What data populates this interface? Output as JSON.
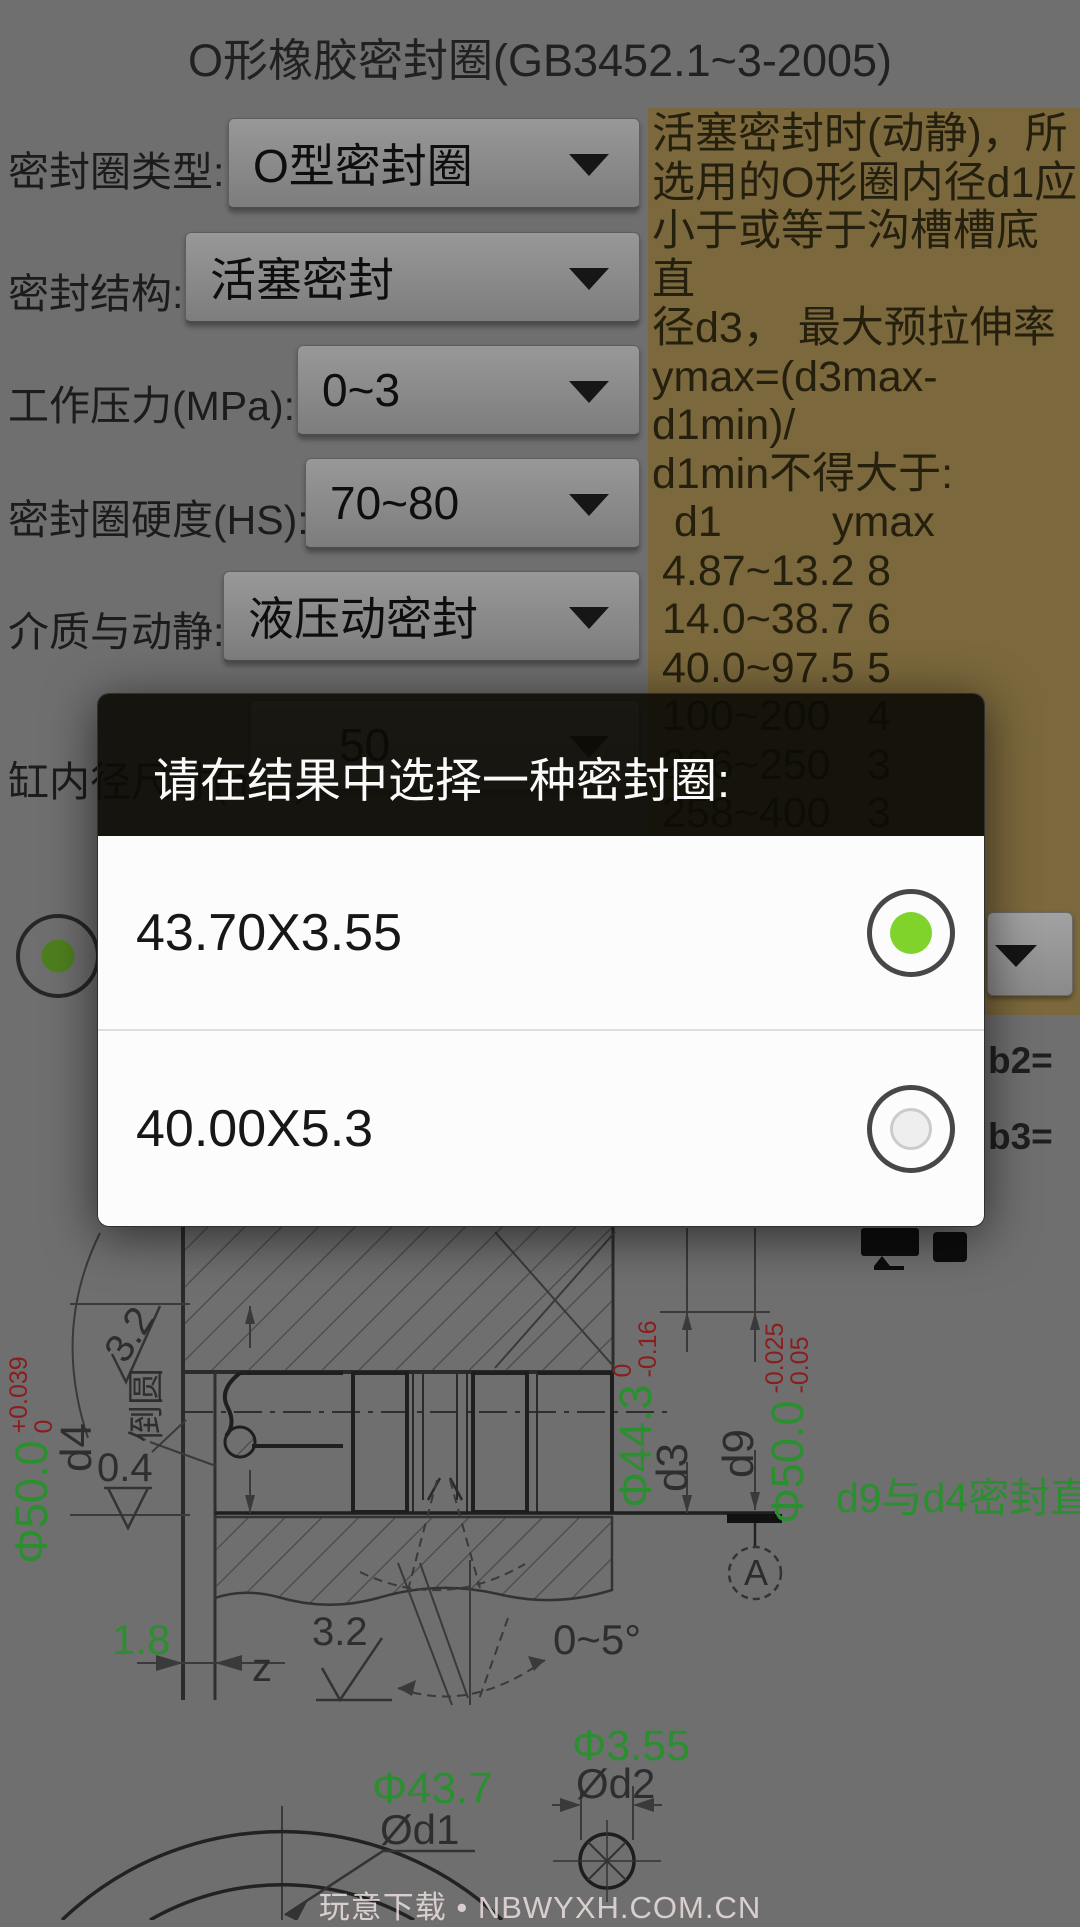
{
  "title": "O形橡胶密封圈(GB3452.1~3-2005)",
  "form": {
    "fields": [
      {
        "label": "密封圈类型:",
        "value": "O型密封圈"
      },
      {
        "label": "密封结构:",
        "value": "活塞密封"
      },
      {
        "label": "工作压力(MPa):",
        "value": "0~3"
      },
      {
        "label": "密封圈硬度(HS):",
        "value": "70~80"
      },
      {
        "label": "介质与动静:",
        "value": "液压动密封"
      },
      {
        "label": "缸内径尺寸(mm):",
        "value": "50"
      }
    ]
  },
  "info_panel": {
    "lines": [
      "活塞密封时(动静)，所",
      "选用的O形圈内径d1应",
      "小于或等于沟槽槽底直",
      "径d3， 最大预拉伸率",
      "ymax=(d3max-d1min)/",
      "d1min不得大于:"
    ],
    "table": {
      "col1": "d1",
      "col2": "ymax",
      "rows": [
        {
          "range": "4.87~13.2",
          "value": "8"
        },
        {
          "range": "14.0~38.7",
          "value": "6"
        },
        {
          "range": "40.0~97.5",
          "value": "5"
        },
        {
          "range": "100~200",
          "value": "4"
        },
        {
          "range": "206~250",
          "value": "3"
        },
        {
          "range": "258~400",
          "value": "3"
        },
        {
          "range": "406~670",
          "value": "2(静)"
        }
      ]
    }
  },
  "dialog": {
    "title": "请在结果中选择一种密封圈:",
    "options": [
      {
        "label": "43.70X3.55",
        "selected": true
      },
      {
        "label": "40.00X5.3",
        "selected": false
      }
    ]
  },
  "partial_labels": {
    "b2": "b2=",
    "b3": "b3="
  },
  "drawing": {
    "dim_d4": {
      "value": "Φ50.0",
      "tol_top": "+0.039",
      "tol_bottom": "0",
      "name": "d4"
    },
    "surface_top": "3.2",
    "fillet_label": "倒圆",
    "surface_left": "0.4",
    "dim_d3": {
      "value": "Φ44.3",
      "tol_top": "0",
      "tol_bottom": "-0.16",
      "name": "d3"
    },
    "dim_d9": {
      "name": "d9",
      "value": "Φ50.0",
      "tol_top": "-0.025",
      "tol_bottom": "-0.05"
    },
    "note": "d9与d4密封直径",
    "datum": "A",
    "depth": "1.8",
    "z_label": "z",
    "surface_bottom": "3.2",
    "angle": "0~5°",
    "dim_d2": {
      "value": "Φ3.55",
      "name": "Ød2"
    },
    "dim_d1": {
      "value": "Φ43.7",
      "name": "Ød1"
    }
  },
  "watermark": "玩意下载 • NBWYXH.COM.CN",
  "colors": {
    "accent_green": "#2a8f2e",
    "tolerance_red": "#8a1d1d",
    "selected_radio": "#80d32a",
    "panel_tan": "#7b683c"
  }
}
